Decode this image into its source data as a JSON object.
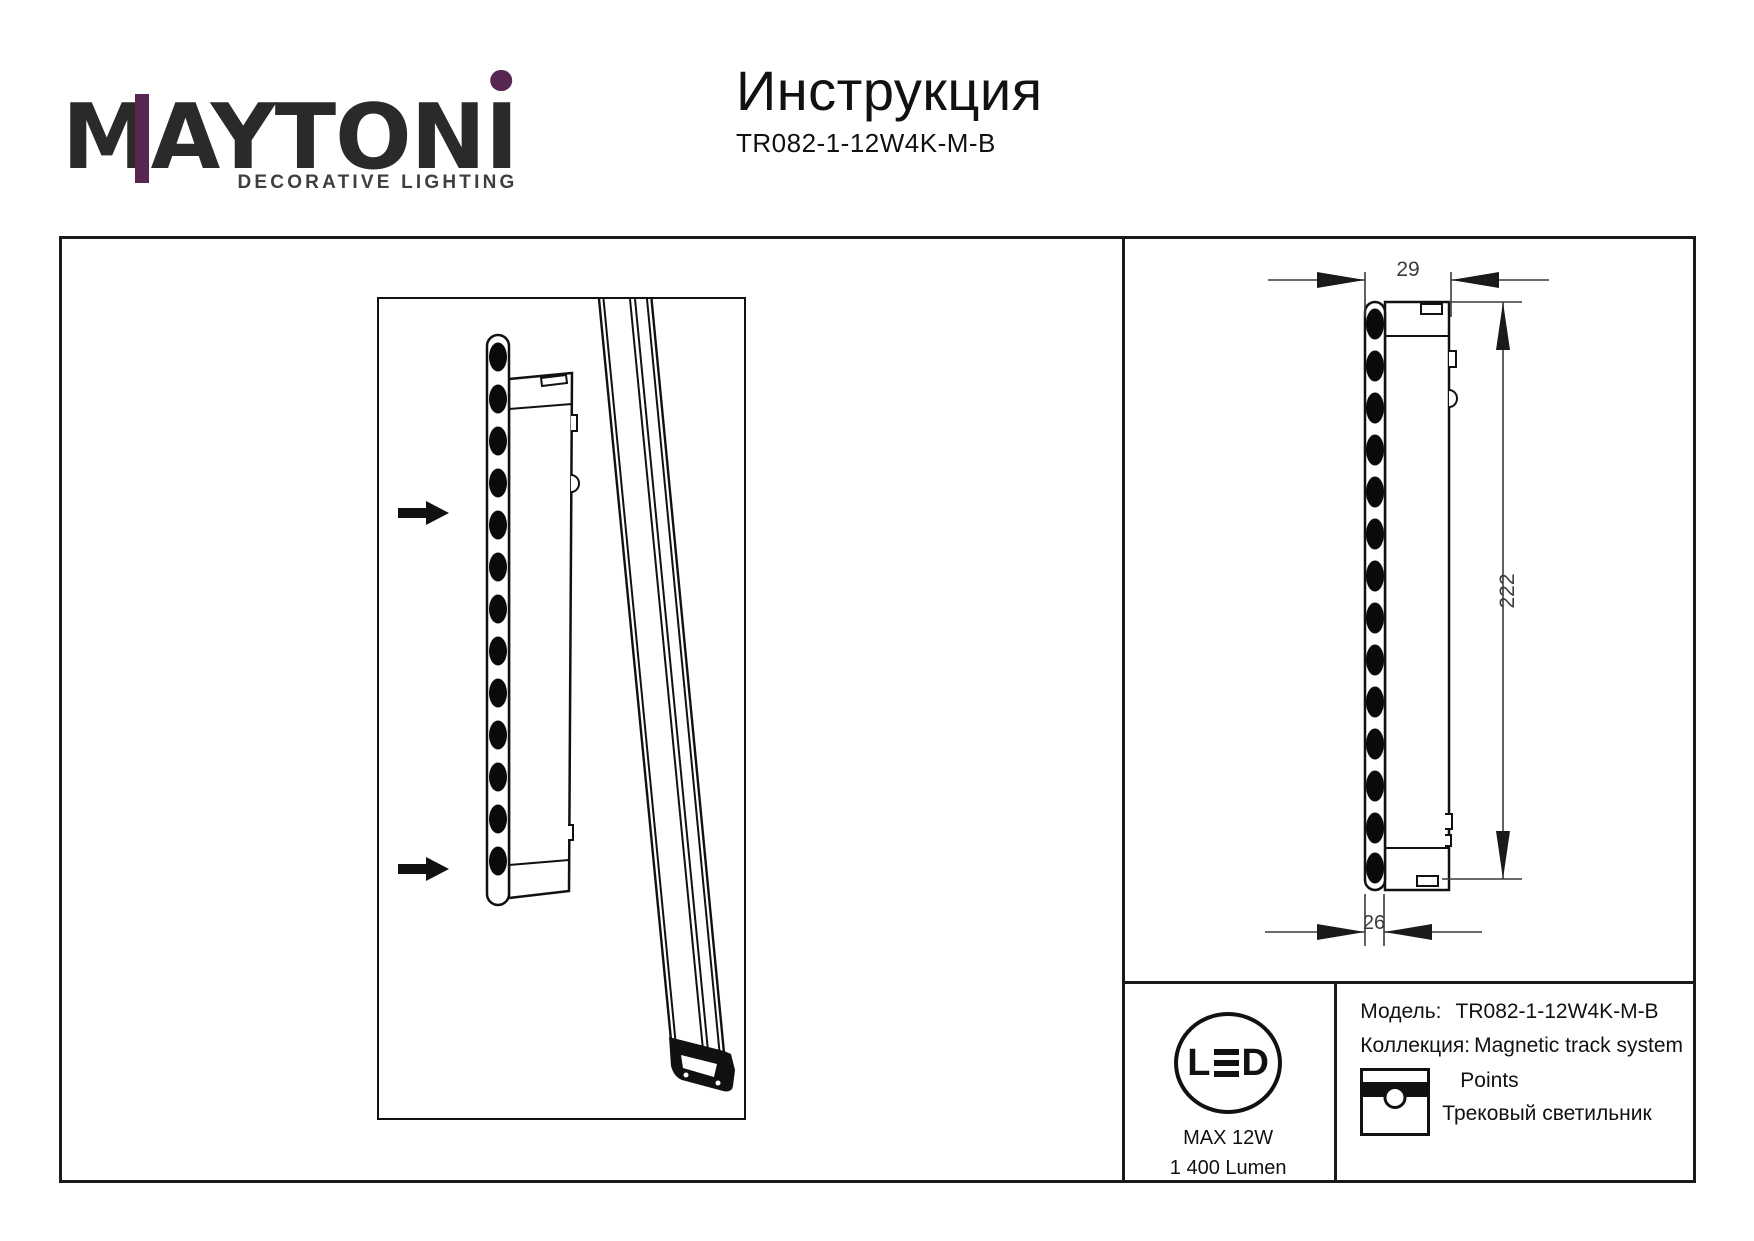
{
  "header": {
    "logo": {
      "wordmark_m": "M",
      "wordmark_mid": "AYTON",
      "wordmark_i": "I",
      "tagline": "DECORATIVE LIGHTING",
      "brand_accent_color": "#582751",
      "brand_text_color": "#2b2a29"
    },
    "title": "Инструкция",
    "model_code": "TR082-1-12W4K-M-B"
  },
  "diagram": {
    "dim_depth_top": "29",
    "dim_height": "222",
    "dim_depth_bottom": "26"
  },
  "info_panel": {
    "led_badge": {
      "l": "L",
      "e": "E",
      "d": "D"
    },
    "max_power": "MAX 12W",
    "luminous_flux": "1 400 Lumen",
    "model_label": "Модель:",
    "model_value": "TR082-1-12W4K-M-B",
    "collection_label": "Коллекция:",
    "collection_value": "Magnetic track system",
    "series_name": "Points",
    "product_type": "Трековый светильник"
  }
}
